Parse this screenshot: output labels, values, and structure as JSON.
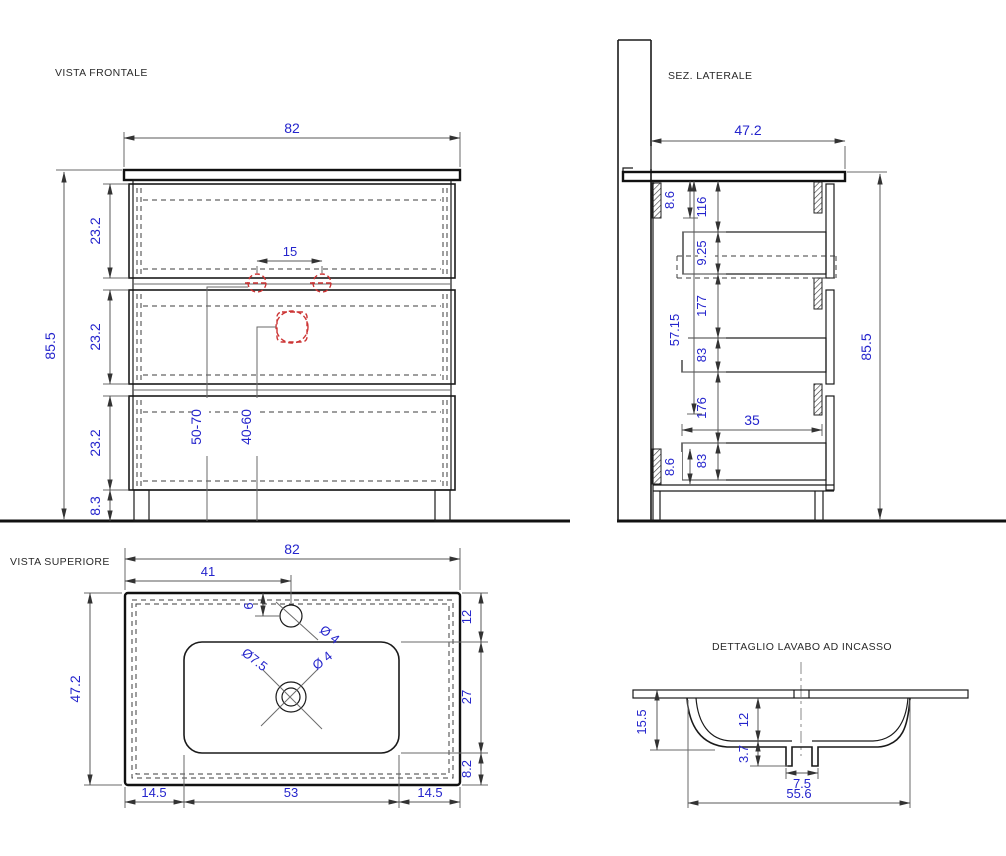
{
  "meta": {
    "bg_color": "#ffffff",
    "line_color": "#1a1a1a",
    "dim_text_color": "#2424cc",
    "detail_red_color": "#cc3333"
  },
  "front": {
    "title": "VISTA FRONTALE",
    "width": "82",
    "height_total": "85.5",
    "drawer1_h": "23.2",
    "drawer2_h": "23.2",
    "drawer3_h": "23.2",
    "plinth_h": "8.3",
    "tap_spacing": "15",
    "supply_range": "50-70",
    "drain_range": "40-60"
  },
  "side": {
    "title": "SEZ. LATERALE",
    "depth": "47.2",
    "height_total": "85.5",
    "gap_top": "8.6",
    "gap_bottom": "8.6",
    "inner_height": "57.15",
    "top_clearance": "116",
    "box1_h": "9.25",
    "spacing1": "177",
    "box2_h": "83",
    "spacing2": "176",
    "box3_h": "83",
    "drawer_depth": "35"
  },
  "top": {
    "title": "VISTA SUPERIORE",
    "width": "82",
    "depth": "47.2",
    "tap_offset_x": "41",
    "tap_offset_y": "6",
    "tap_dia": "Ø 4",
    "drain_dia_outer": "Ø7.5",
    "drain_dia_inner": "Ø 4",
    "back_margin": "12",
    "basin_depth": "27",
    "front_margin": "8.2",
    "side_margin_left": "14.5",
    "basin_width": "53",
    "side_margin_right": "14.5"
  },
  "detail": {
    "title": "DETTAGLIO LAVABO AD INCASSO",
    "total_depth": "15.5",
    "bowl_depth": "12",
    "drain_drop": "3.7",
    "drain_width": "7.5",
    "bowl_width": "55.6"
  }
}
